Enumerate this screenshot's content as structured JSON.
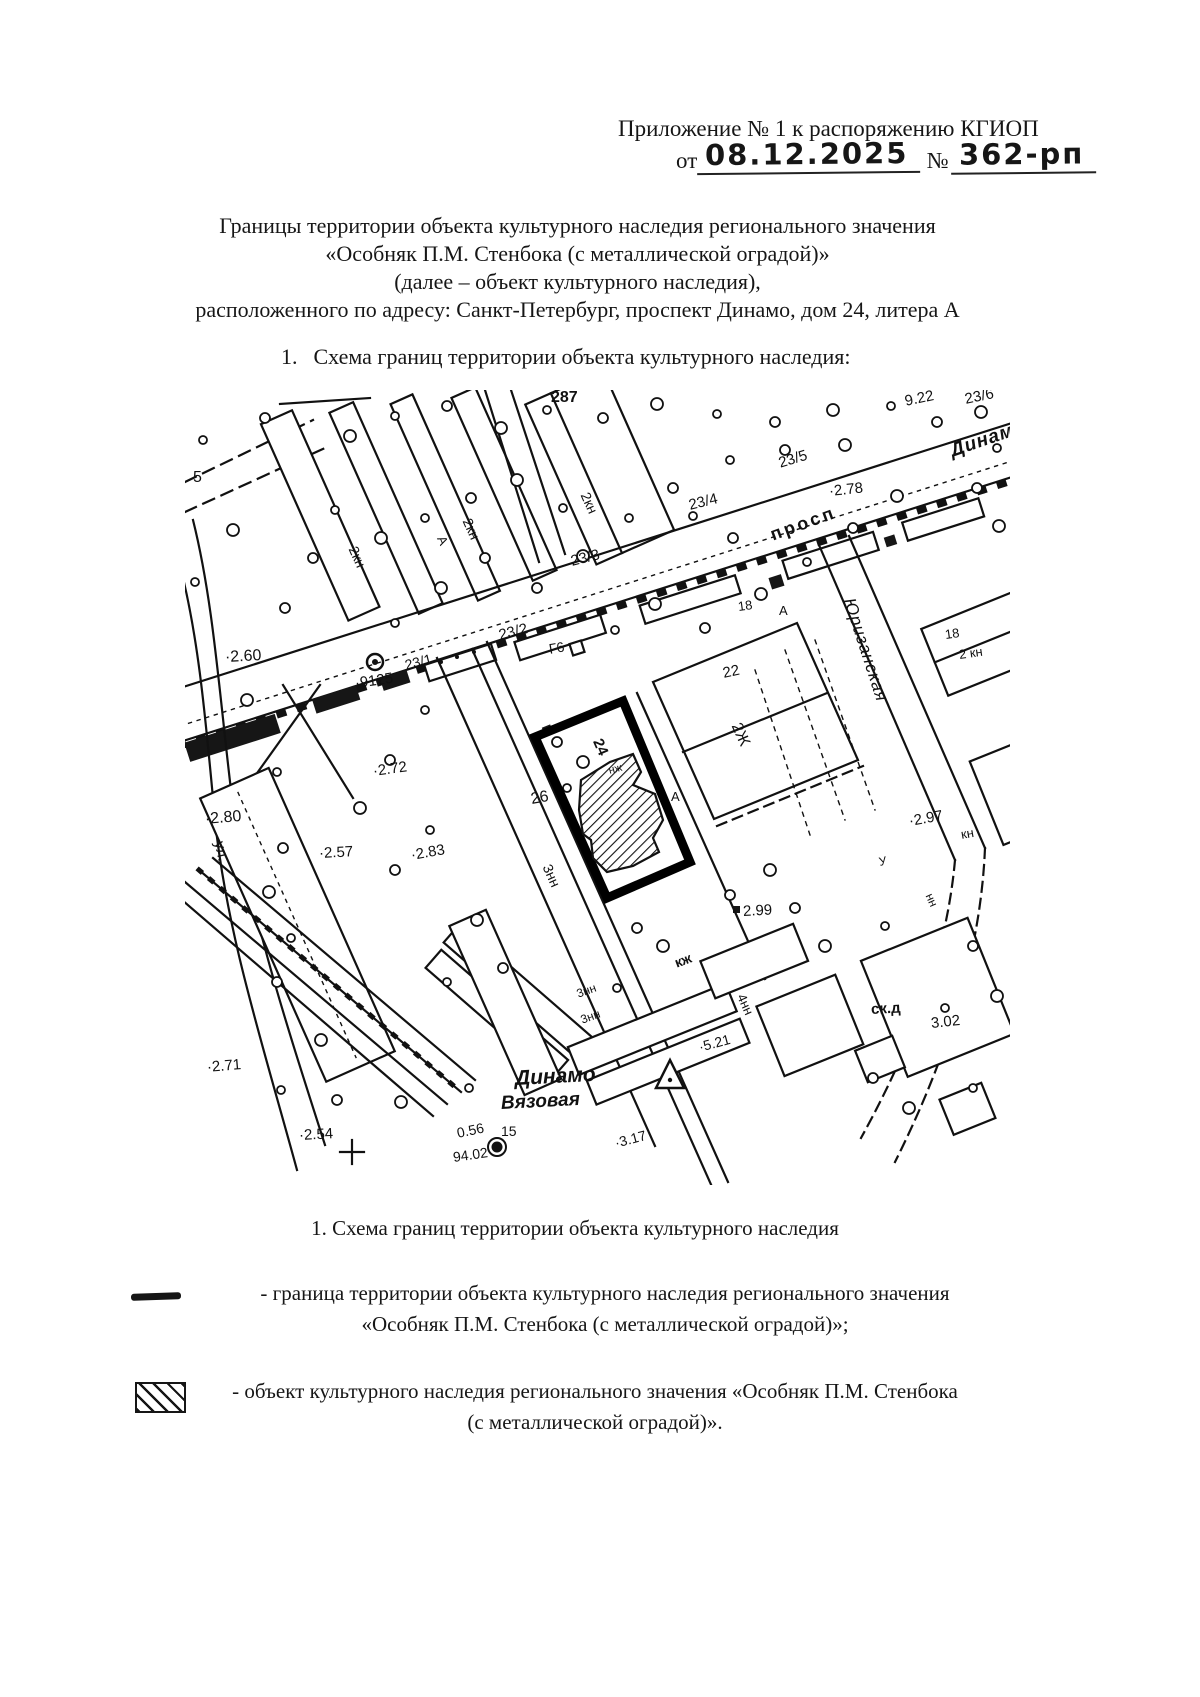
{
  "doc": {
    "header": {
      "line1": "Приложение № 1 к распоряжению КГИОП",
      "date_prefix": "от",
      "date_value": "08.12.2025",
      "number_prefix": "№",
      "number_value": "362-рп"
    },
    "title": {
      "line1": "Границы территории объекта культурного наследия регионального значения",
      "line2": "«Особняк П.М. Стенбока (с металлической оградой)»",
      "line3": "(далее – объект культурного наследия),",
      "line4": "расположенного по адресу: Санкт-Петербург, проспект Динамо, дом 24, литера А"
    },
    "section1_num": "1.",
    "section1_text": "Схема границ территории объекта культурного наследия:",
    "map_caption": "1. Схема границ территории объекта культурного наследия",
    "legend": {
      "item1_line1": "- граница территории объекта культурного наследия регионального значения",
      "item1_line2": "«Особняк П.М. Стенбока (с металлической оградой)»;",
      "item2_line1": "- объект культурного наследия регионального значения «Особняк П.М. Стенбока",
      "item2_line2": "(с металлической оградой)»."
    }
  },
  "map": {
    "labels": [
      {
        "t": "287",
        "x": 366,
        "y": 0,
        "s": 16,
        "r": 0,
        "b": 1
      },
      {
        "t": "9.22",
        "x": 720,
        "y": 4,
        "s": 15,
        "r": -12
      },
      {
        "t": "23/6",
        "x": 780,
        "y": 2,
        "s": 15,
        "r": -12
      },
      {
        "t": "Динамо",
        "x": 766,
        "y": 52,
        "s": 19,
        "r": -19,
        "b": 1,
        "i": 1,
        "sp": 1
      },
      {
        "t": "23/5",
        "x": 594,
        "y": 66,
        "s": 15,
        "r": -17
      },
      {
        "t": "·2.78",
        "x": 644,
        "y": 94,
        "s": 15,
        "r": -6
      },
      {
        "t": "23/4",
        "x": 504,
        "y": 108,
        "s": 15,
        "r": -14
      },
      {
        "t": "просп",
        "x": 586,
        "y": 136,
        "s": 18,
        "r": -20,
        "b": 1,
        "sp": 3
      },
      {
        "t": "23/3",
        "x": 386,
        "y": 164,
        "s": 15,
        "r": -14
      },
      {
        "t": "23/2",
        "x": 314,
        "y": 238,
        "s": 15,
        "r": -14
      },
      {
        "t": "Г6",
        "x": 364,
        "y": 252,
        "s": 14,
        "r": -10
      },
      {
        "t": "18",
        "x": 553,
        "y": 210,
        "s": 13,
        "r": -8
      },
      {
        "t": "А",
        "x": 594,
        "y": 214,
        "s": 13,
        "r": 0
      },
      {
        "t": "А",
        "x": 256,
        "y": 140,
        "s": 13,
        "r": 66
      },
      {
        "t": "А",
        "x": 486,
        "y": 400,
        "s": 13,
        "r": 0
      },
      {
        "t": "2кн",
        "x": 168,
        "y": 150,
        "s": 14,
        "r": 66
      },
      {
        "t": "2кн",
        "x": 282,
        "y": 122,
        "s": 14,
        "r": 66
      },
      {
        "t": "2кн",
        "x": 400,
        "y": 96,
        "s": 14,
        "r": 66
      },
      {
        "t": "18",
        "x": 760,
        "y": 238,
        "s": 13,
        "r": -8
      },
      {
        "t": "2 кн",
        "x": 774,
        "y": 258,
        "s": 13,
        "r": -8
      },
      {
        "t": "5",
        "x": 8,
        "y": 80,
        "s": 16,
        "r": 0
      },
      {
        "t": "·2.60",
        "x": 40,
        "y": 260,
        "s": 16,
        "r": -3
      },
      {
        "t": "·9125",
        "x": 170,
        "y": 286,
        "s": 15,
        "r": -8
      },
      {
        "t": "23/1",
        "x": 220,
        "y": 268,
        "s": 14,
        "r": -14
      },
      {
        "t": "·2.72",
        "x": 188,
        "y": 374,
        "s": 15,
        "r": -8
      },
      {
        "t": "·2.80",
        "x": 20,
        "y": 422,
        "s": 16,
        "r": -5
      },
      {
        "t": "·2.83",
        "x": 226,
        "y": 458,
        "s": 15,
        "r": -10
      },
      {
        "t": "ул.",
        "x": 34,
        "y": 444,
        "s": 15,
        "r": 78
      },
      {
        "t": "·2.57",
        "x": 134,
        "y": 456,
        "s": 15,
        "r": -3
      },
      {
        "t": "·2.71",
        "x": 22,
        "y": 670,
        "s": 15,
        "r": -5
      },
      {
        "t": "·2.54",
        "x": 114,
        "y": 738,
        "s": 15,
        "r": -3
      },
      {
        "t": "Динамо",
        "x": 330,
        "y": 678,
        "s": 21,
        "r": -3,
        "b": 1,
        "i": 1
      },
      {
        "t": "Вязовая",
        "x": 316,
        "y": 704,
        "s": 19,
        "r": -3,
        "b": 1,
        "i": 1
      },
      {
        "t": "0.56",
        "x": 272,
        "y": 736,
        "s": 14,
        "r": -12
      },
      {
        "t": "94.02",
        "x": 268,
        "y": 760,
        "s": 14,
        "r": -8
      },
      {
        "t": "15",
        "x": 316,
        "y": 734,
        "s": 14,
        "r": 0
      },
      {
        "t": "·3.17",
        "x": 430,
        "y": 746,
        "s": 14,
        "r": -15
      },
      {
        "t": "·5.21",
        "x": 514,
        "y": 650,
        "s": 14,
        "r": -15
      },
      {
        "t": "2.99",
        "x": 558,
        "y": 514,
        "s": 15,
        "r": -3
      },
      {
        "t": "·2.97",
        "x": 724,
        "y": 424,
        "s": 15,
        "r": -10
      },
      {
        "t": "ск.д",
        "x": 686,
        "y": 612,
        "s": 15,
        "r": -3,
        "b": 1
      },
      {
        "t": "3.02",
        "x": 746,
        "y": 626,
        "s": 15,
        "r": -6
      },
      {
        "t": "Юризанская",
        "x": 664,
        "y": 200,
        "s": 17,
        "r": 72,
        "i": 1,
        "sp": 1
      },
      {
        "t": "22",
        "x": 538,
        "y": 276,
        "s": 15,
        "r": -12
      },
      {
        "t": "2Ж",
        "x": 550,
        "y": 326,
        "s": 16,
        "r": 66
      },
      {
        "t": "24",
        "x": 412,
        "y": 342,
        "s": 15,
        "r": 66,
        "b": 1
      },
      {
        "t": "26",
        "x": 346,
        "y": 402,
        "s": 16,
        "r": -10
      },
      {
        "t": "нж",
        "x": 424,
        "y": 376,
        "s": 11,
        "r": -15
      },
      {
        "t": "3нн",
        "x": 362,
        "y": 468,
        "s": 14,
        "r": 66
      },
      {
        "t": "кж",
        "x": 490,
        "y": 566,
        "s": 14,
        "r": -20,
        "b": 1
      },
      {
        "t": "3нн",
        "x": 392,
        "y": 598,
        "s": 12,
        "r": -20
      },
      {
        "t": "3нн",
        "x": 396,
        "y": 624,
        "s": 12,
        "r": -20
      },
      {
        "t": "4нн",
        "x": 556,
        "y": 598,
        "s": 13,
        "r": 66
      },
      {
        "t": "кн",
        "x": 776,
        "y": 438,
        "s": 13,
        "r": -10
      },
      {
        "t": "нн",
        "x": 744,
        "y": 498,
        "s": 12,
        "r": 66
      },
      {
        "t": "У",
        "x": 694,
        "y": 466,
        "s": 12,
        "r": -12
      }
    ]
  },
  "colors": {
    "ink": "#161616",
    "paper": "#ffffff",
    "boundary": "#000000"
  }
}
